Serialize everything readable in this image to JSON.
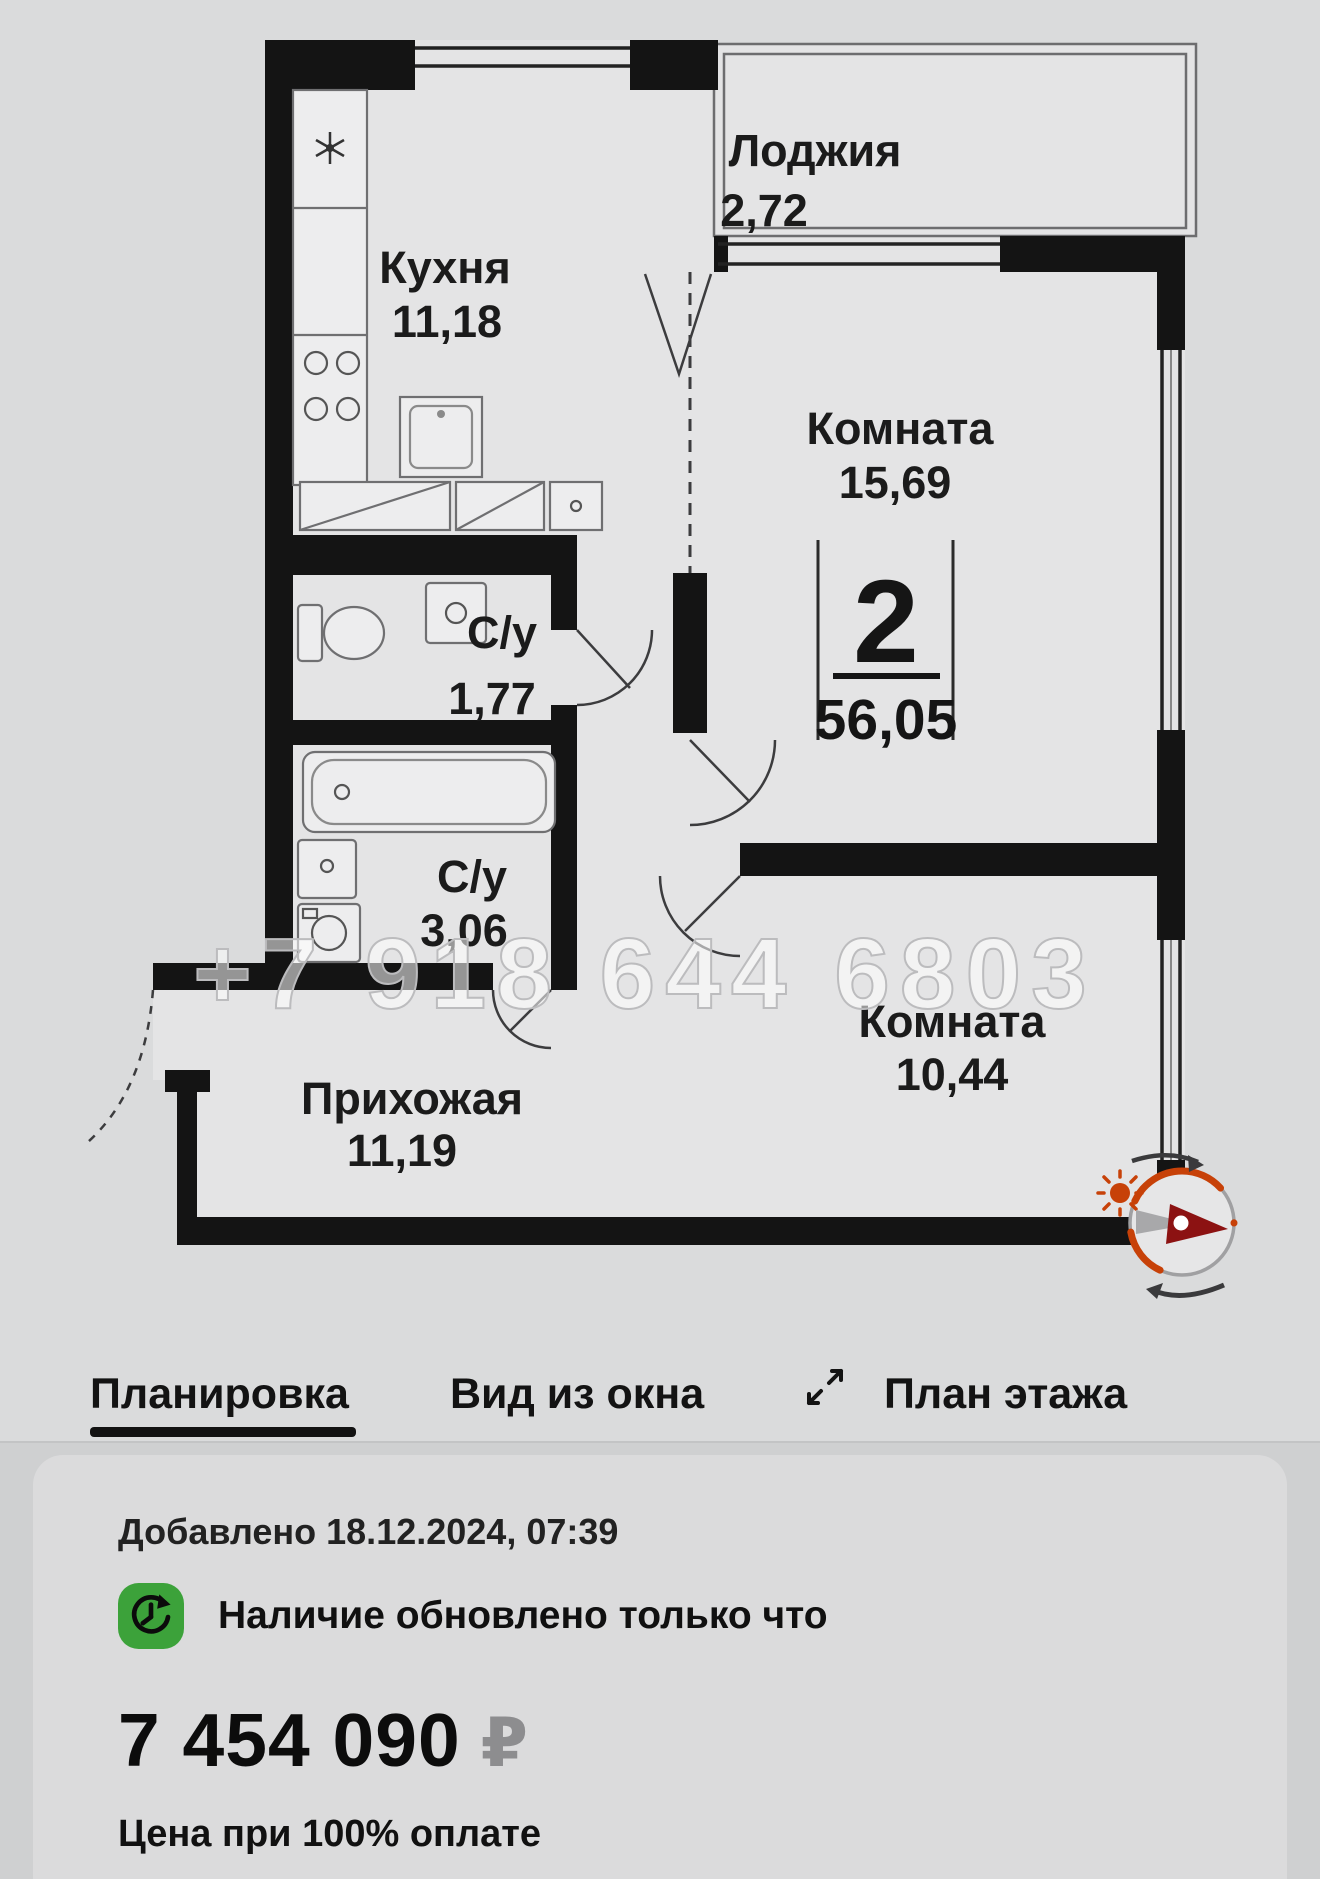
{
  "plan": {
    "watermark": "+7 918 644 6803",
    "badge": {
      "rooms": "2",
      "total_area": "56,05"
    },
    "rooms": {
      "kitchen": {
        "name": "Кухня",
        "area": "11,18"
      },
      "loggia": {
        "name": "Лоджия",
        "area": "2,72"
      },
      "room1": {
        "name": "Комната",
        "area": "15,69"
      },
      "wc1": {
        "name": "С/у",
        "area": "1,77"
      },
      "wc2": {
        "name": "С/у",
        "area": "3,06"
      },
      "hall": {
        "name": "Прихожая",
        "area": "11,19"
      },
      "room2": {
        "name": "Комната",
        "area": "10,44"
      }
    }
  },
  "tabs": {
    "layout": "Планировка",
    "window_view": "Вид из окна",
    "floor_plan": "План этажа"
  },
  "listing": {
    "added": "Добавлено 18.12.2024, 07:39",
    "availability": "Наличие обновлено только что",
    "price": "7 454 090",
    "currency": "₽",
    "payment_note": "Цена при 100% оплате"
  },
  "colors": {
    "accent_green": "#3ca23a",
    "compass_orange": "#c74108",
    "needle_red": "#8c1212",
    "wall_black": "#141414"
  }
}
